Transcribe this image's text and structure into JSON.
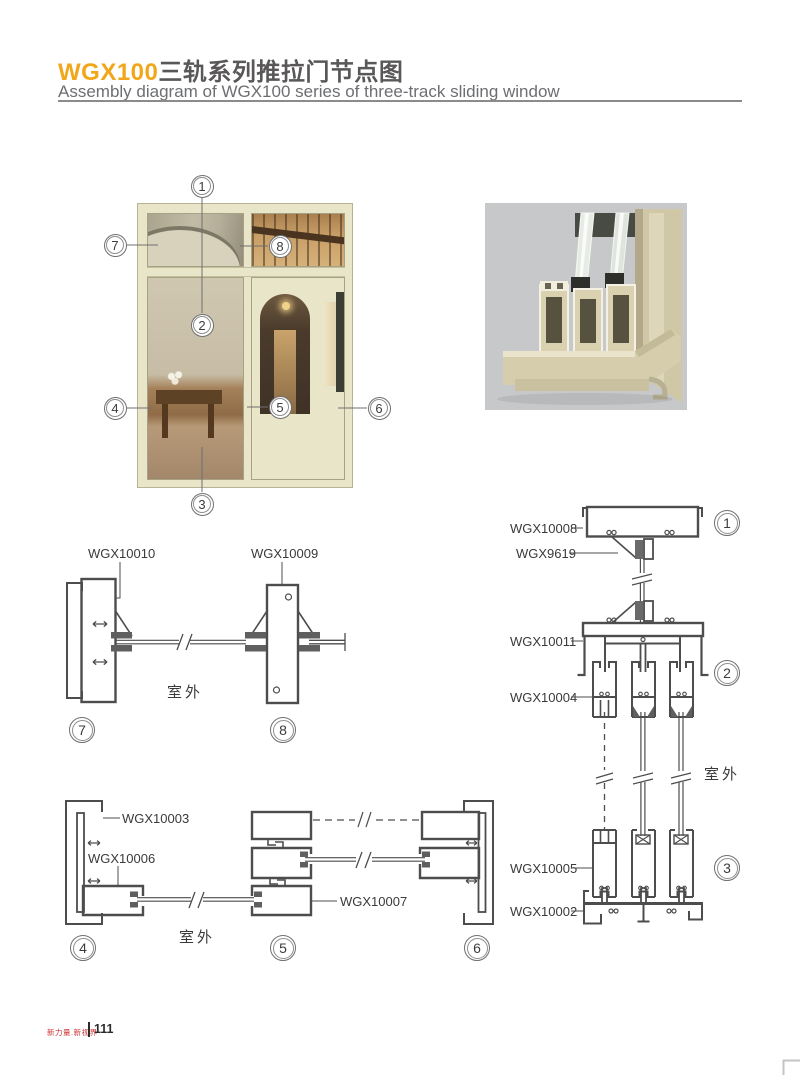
{
  "header": {
    "title_code": "WGX100",
    "title_zh": "三轨系列推拉门节点图",
    "subtitle": "Assembly diagram of WGX100 series of three-track sliding window"
  },
  "photo": {
    "callouts": [
      "1",
      "2",
      "3",
      "4",
      "5",
      "6",
      "7",
      "8"
    ]
  },
  "details": {
    "s78": {
      "part_a": "WGX10010",
      "part_b": "WGX10009",
      "outdoor": "室外",
      "marker_a": "7",
      "marker_b": "8"
    },
    "s456": {
      "part_a": "WGX10003",
      "part_b": "WGX10006",
      "part_c": "WGX10007",
      "outdoor": "室外",
      "marker_a": "4",
      "marker_b": "5",
      "marker_c": "6"
    },
    "s123": {
      "part_a": "WGX10008",
      "part_b": "WGX9619",
      "part_c": "WGX10011",
      "part_d": "WGX10004",
      "part_e": "WGX10005",
      "part_f": "WGX10002",
      "outdoor": "室外",
      "marker_a": "1",
      "marker_b": "2",
      "marker_c": "3"
    }
  },
  "footer": {
    "brand": "新力量.新视界",
    "page": "111"
  },
  "colors": {
    "accent_orange": "#F2A71B",
    "title_dark": "#595757",
    "subtitle_gray": "#6D6E71",
    "drawing_line": "#4D4D4D",
    "footer_red": "#CC3333",
    "photo_frame_cream": "#E9E5C8",
    "render_bg_gray": "#C6C8CA",
    "profile_beige": "#D8D0AE"
  }
}
